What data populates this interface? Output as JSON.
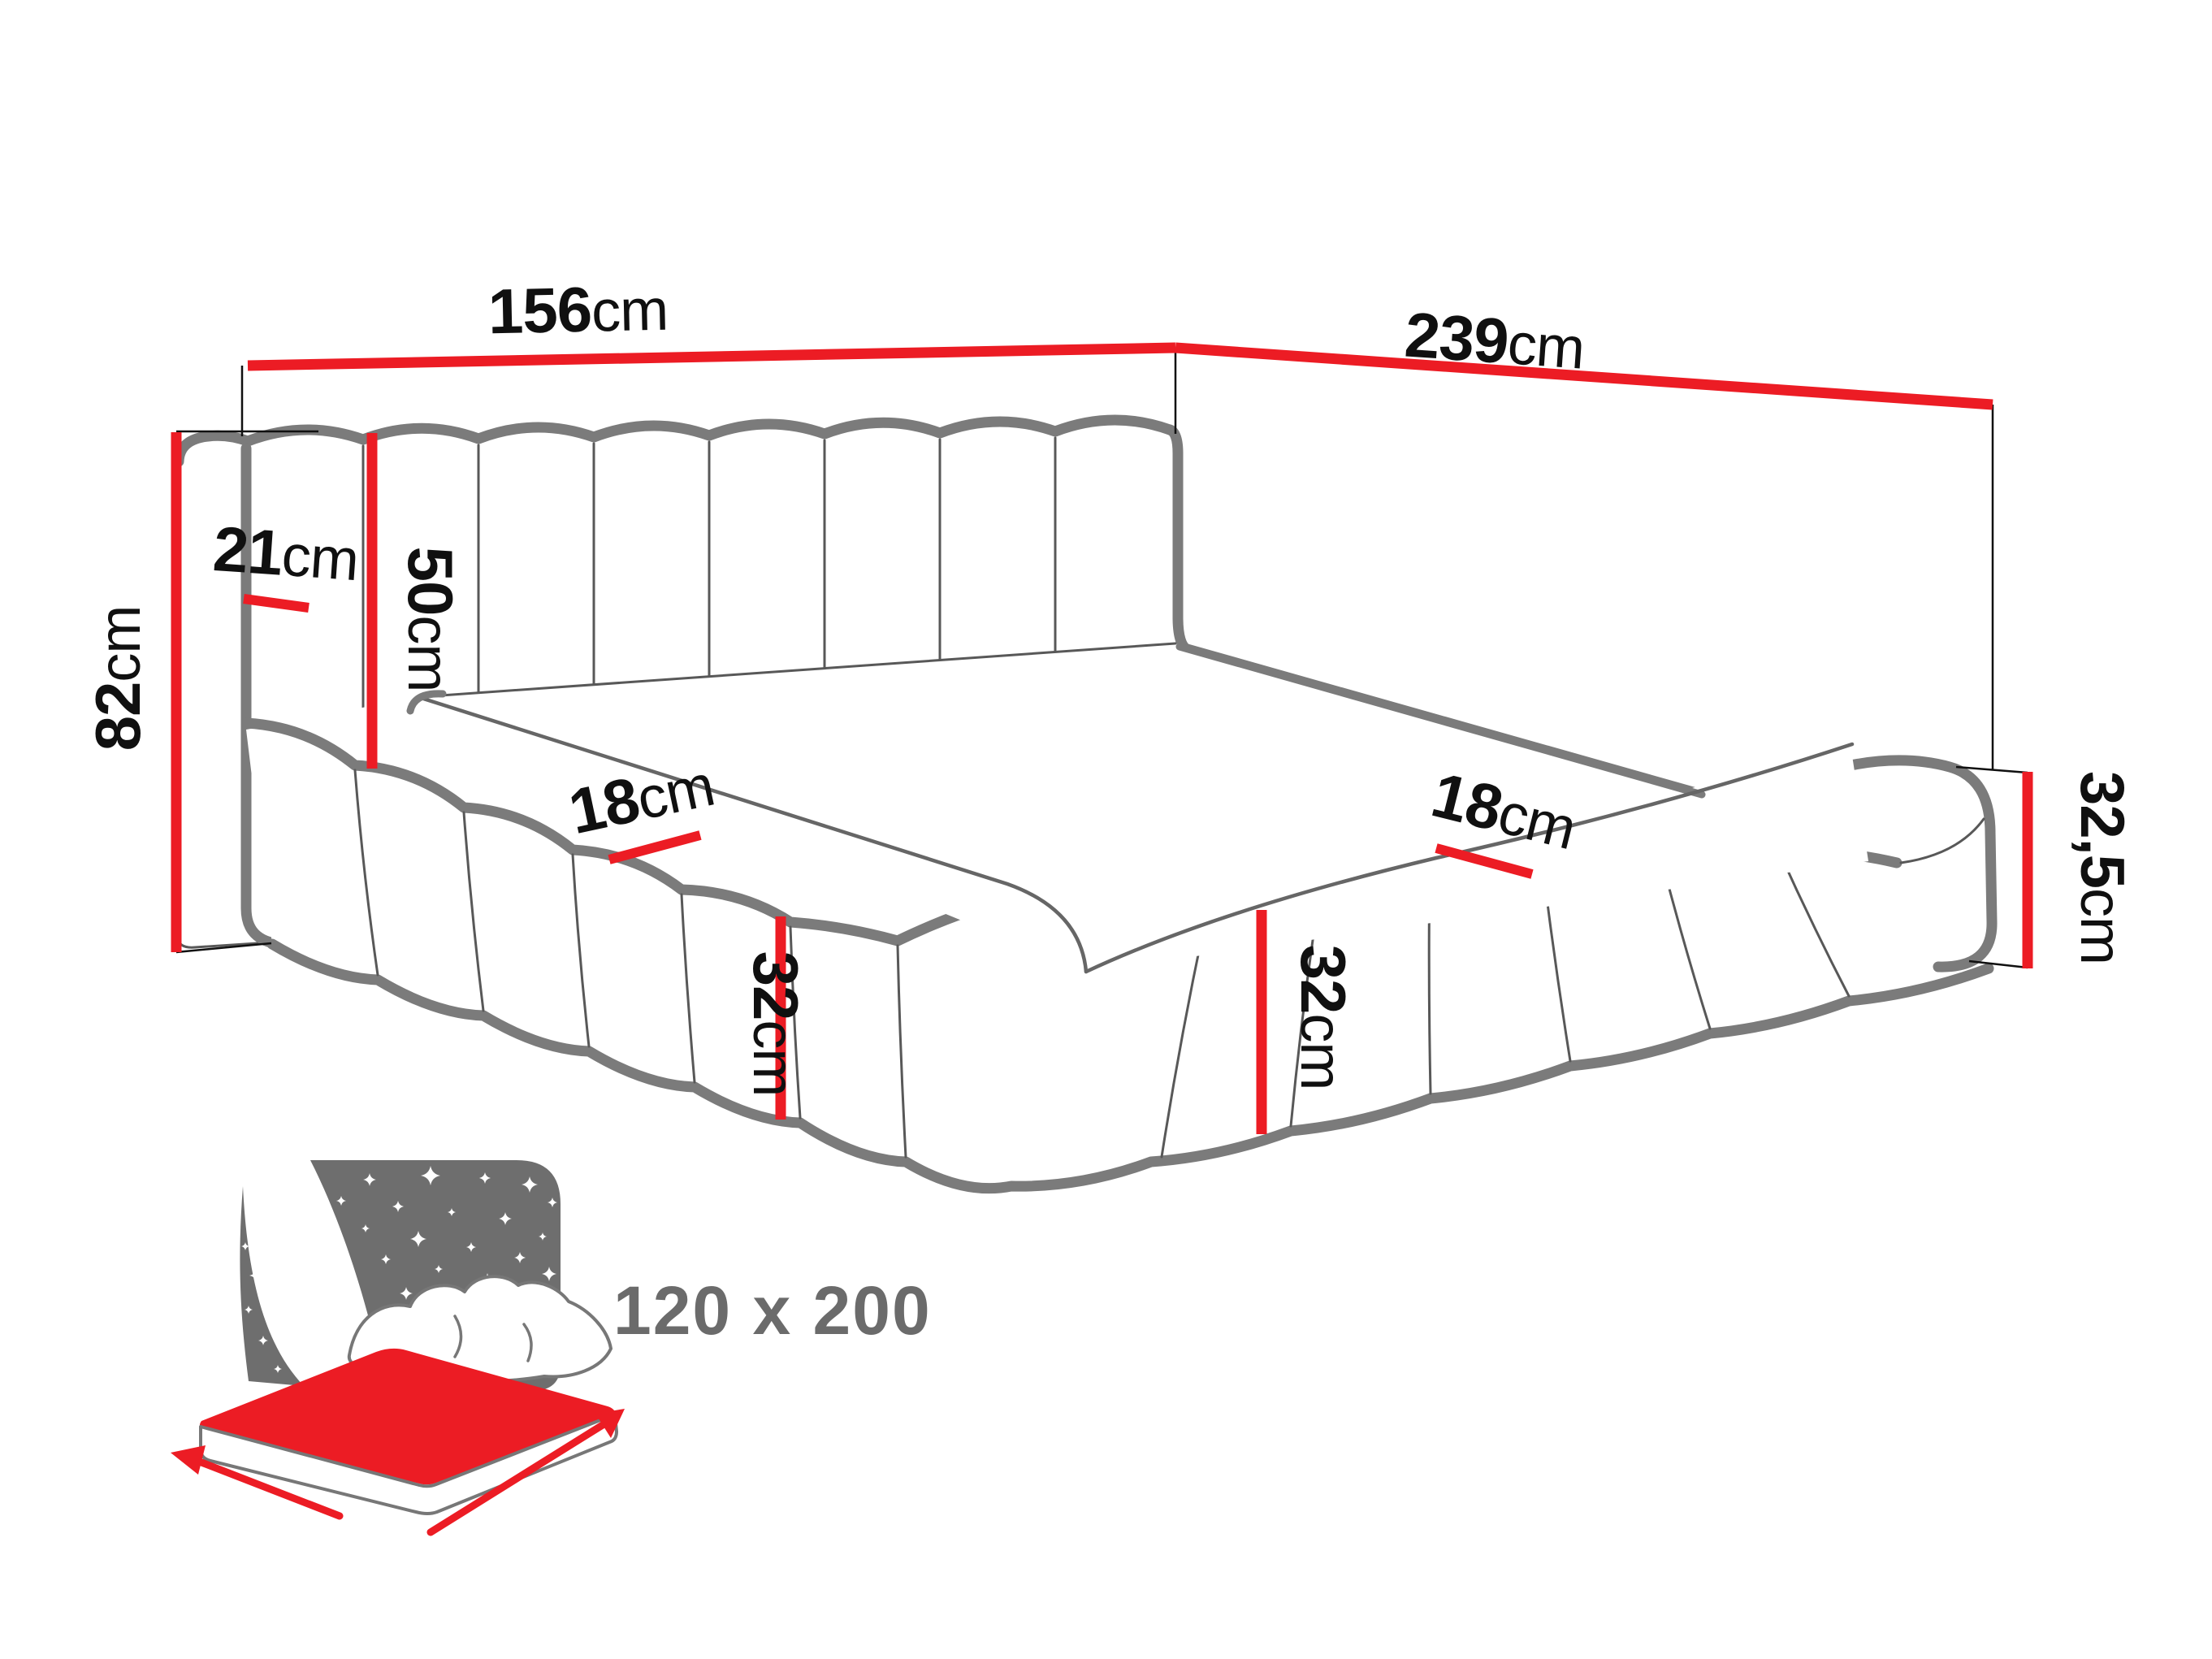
{
  "diagram_title": "upholstered channel-tufted corner bed dimension drawing",
  "dimensions": {
    "w156": {
      "value": "156",
      "unit": "cm"
    },
    "l239": {
      "value": "239",
      "unit": "cm"
    },
    "h82": {
      "value": "82",
      "unit": "cm"
    },
    "d21": {
      "value": "21",
      "unit": "cm"
    },
    "h50": {
      "value": "50",
      "unit": "cm"
    },
    "t18a": {
      "value": "18",
      "unit": "cm"
    },
    "t18b": {
      "value": "18",
      "unit": "cm"
    },
    "h32a": {
      "value": "32",
      "unit": "cm"
    },
    "h32b": {
      "value": "32",
      "unit": "cm"
    },
    "h325": {
      "value": "32,5",
      "unit": "cm"
    }
  },
  "badge": {
    "mattress_size": "120 x 200"
  },
  "colors": {
    "dimension_red": "#ec1c24",
    "outline_gray": "#7b7b7b",
    "line_thin": "#585858",
    "mattress_line": "#666666",
    "ink": "#101010",
    "icon_gray": "#6e6e6e",
    "size_text_gray": "#6b6b6b"
  }
}
